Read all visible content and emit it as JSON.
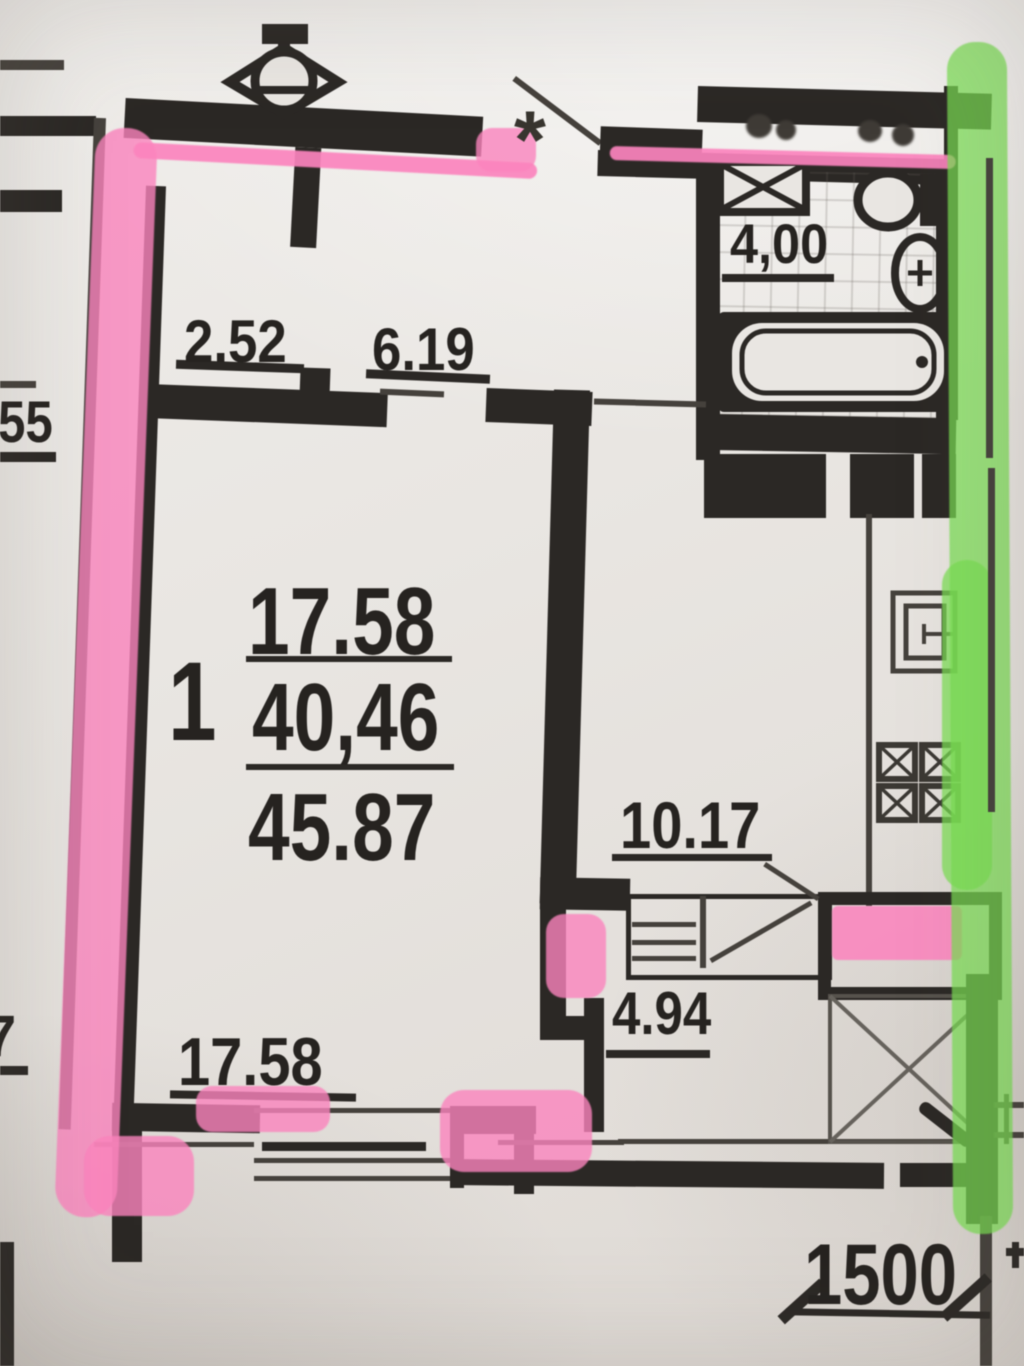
{
  "colors": {
    "paper": "#e9e5e1",
    "wall": "#2b2825",
    "thin": "#45413c",
    "pink": "#fb84bd",
    "green": "#79dd52",
    "text": "#262320"
  },
  "texts": {
    "star": "*",
    "d252": "2.52",
    "d619": "6.19",
    "d55": "55",
    "d400": "4,00",
    "d1017": "10.17",
    "d494": "4.94",
    "d1758_bottom": "17.58",
    "d7": "7",
    "d1500": "1500",
    "unit": {
      "rooms": "1",
      "line1": "17.58",
      "line2": "40,46",
      "line3": "45.87"
    }
  }
}
